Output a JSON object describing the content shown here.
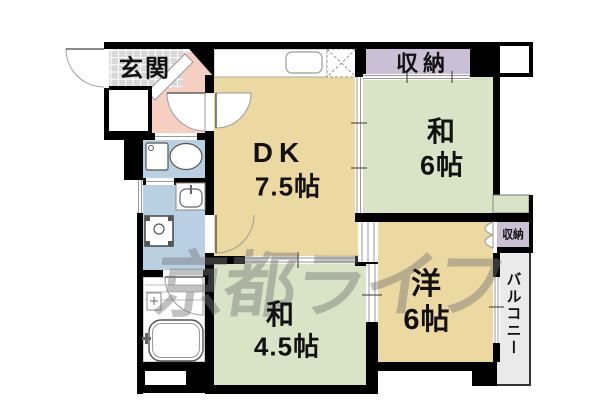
{
  "plan_title": "2DK floor plan",
  "colors": {
    "wall": "#000000",
    "dk_floor": "#ecd9a1",
    "western_floor": "#ecd9a1",
    "tatami_floor": "#d8e4c5",
    "storage": "#cbbfd6",
    "hallway": "#f7cfc1",
    "wet_area": "#b9d0e2",
    "entrance_tile": "#d8d8d8",
    "bathroom": "#ffffff",
    "balcony": "#eaeaea",
    "watermark_gray": "rgba(120,120,120,0.45)"
  },
  "rooms": {
    "entrance": {
      "label": "玄関"
    },
    "closet_north": {
      "label": "収納"
    },
    "dk": {
      "label": "DK",
      "size": "7.5帖"
    },
    "japanese_6": {
      "label": "和",
      "size": "6帖"
    },
    "japanese_45": {
      "label": "和",
      "size": "4.5帖"
    },
    "western_6": {
      "label": "洋",
      "size": "6帖"
    },
    "closet_west": {
      "label": "収納"
    },
    "balcony": {
      "label": "バルコニー"
    }
  },
  "watermark": {
    "text": "京都ライフ"
  },
  "fixtures": {
    "toilet": "toilet-icon",
    "washbasin": "washbasin-icon",
    "washing_machine": "washing-machine-icon",
    "bathtub": "bathtub-icon",
    "kitchen_sink": "kitchen-sink-icon",
    "refrigerator_space": "refrigerator-space-icon"
  }
}
